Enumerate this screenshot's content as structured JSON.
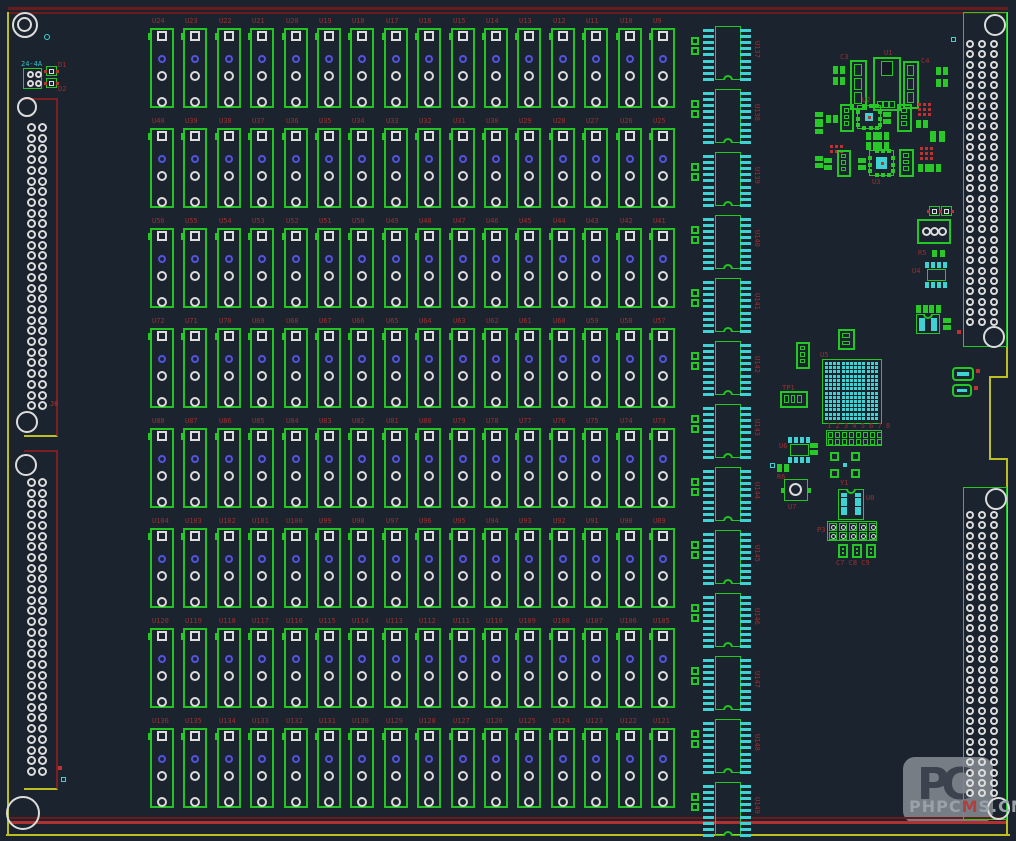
{
  "watermark": {
    "logo": "PC",
    "text_left": "PHPC",
    "text_accent": "M",
    "text_right": "S.CN"
  },
  "colors": {
    "background": "#1b232e",
    "green": "#21c421",
    "bright_green": "#2ad82a",
    "cyan_pad": "#3ed2d2",
    "cyan_text": "#2fc2c2",
    "white_pad": "#dcdcdc",
    "blue_pad": "#5253de",
    "ref_red": "#9c2f2f",
    "via_red": "#c03030",
    "edge_dark_red": "#6a1b1b",
    "edge_red": "#b23030",
    "edge_yellow": "#bdbd24"
  },
  "outline": [
    {
      "x": 8,
      "y": 7,
      "w": 1000,
      "h": 3,
      "c": "#6a1b1b"
    },
    {
      "x": 8,
      "y": 12,
      "w": 1000,
      "h": 2,
      "c": "#6a1b1b"
    },
    {
      "x": 8,
      "y": 817,
      "w": 1000,
      "h": 2,
      "c": "#6a1b1b"
    },
    {
      "x": 8,
      "y": 821,
      "w": 1000,
      "h": 3,
      "c": "#b23030"
    },
    {
      "x": 6,
      "y": 834,
      "w": 1004,
      "h": 2,
      "c": "#bdbd24"
    },
    {
      "x": 7,
      "y": 12,
      "w": 2,
      "h": 824,
      "c": "#bdbd24"
    },
    {
      "x": 1006,
      "y": 12,
      "w": 2,
      "h": 366,
      "c": "#bdbd24"
    },
    {
      "x": 990,
      "y": 376,
      "w": 18,
      "h": 2,
      "c": "#bdbd24"
    },
    {
      "x": 989,
      "y": 376,
      "w": 2,
      "h": 84,
      "c": "#bdbd24"
    },
    {
      "x": 990,
      "y": 458,
      "w": 18,
      "h": 2,
      "c": "#bdbd24"
    },
    {
      "x": 1006,
      "y": 458,
      "w": 2,
      "h": 378,
      "c": "#bdbd24"
    }
  ],
  "grid": {
    "origin_x": 150,
    "origin_y": 28,
    "pitch_x": 33.4,
    "pitch_y": 100,
    "fp_w": 24,
    "fp_h": 80,
    "rows": 8,
    "cols": 16,
    "refs": [
      "U24",
      "U23",
      "U22",
      "U21",
      "U20",
      "U19",
      "U18",
      "U17",
      "U16",
      "U15",
      "U14",
      "U13",
      "U12",
      "U11",
      "U10",
      "U9",
      "U40",
      "U39",
      "U38",
      "U37",
      "U36",
      "U35",
      "U34",
      "U33",
      "U32",
      "U31",
      "U30",
      "U29",
      "U28",
      "U27",
      "U26",
      "U25",
      "U56",
      "U55",
      "U54",
      "U53",
      "U52",
      "U51",
      "U50",
      "U49",
      "U48",
      "U47",
      "U46",
      "U45",
      "U44",
      "U43",
      "U42",
      "U41",
      "U72",
      "U71",
      "U70",
      "U69",
      "U68",
      "U67",
      "U66",
      "U65",
      "U64",
      "U63",
      "U62",
      "U61",
      "U60",
      "U59",
      "U58",
      "U57",
      "U88",
      "U87",
      "U86",
      "U85",
      "U84",
      "U83",
      "U82",
      "U81",
      "U80",
      "U79",
      "U78",
      "U77",
      "U76",
      "U75",
      "U74",
      "U73",
      "U104",
      "U103",
      "U102",
      "U101",
      "U100",
      "U99",
      "U98",
      "U97",
      "U96",
      "U95",
      "U94",
      "U93",
      "U92",
      "U91",
      "U90",
      "U89",
      "U120",
      "U119",
      "U118",
      "U117",
      "U116",
      "U115",
      "U114",
      "U113",
      "U112",
      "U111",
      "U110",
      "U109",
      "U108",
      "U107",
      "U106",
      "U105",
      "U136",
      "U135",
      "U134",
      "U133",
      "U132",
      "U131",
      "U130",
      "U129",
      "U128",
      "U127",
      "U126",
      "U125",
      "U124",
      "U123",
      "U122",
      "U121"
    ]
  },
  "dips": {
    "x": 703,
    "y0": 25,
    "pitch": 63,
    "h": 56,
    "count": 13,
    "refs": [
      "U137",
      "U138",
      "U139",
      "U140",
      "U141",
      "U142",
      "U143",
      "U144",
      "U145",
      "U146",
      "U147",
      "U148",
      "U149"
    ]
  },
  "left_connectors": [
    {
      "x": 24,
      "y": 98,
      "w": 34,
      "h": 339,
      "pad_y0": 123,
      "rows": 27,
      "label": "J6",
      "label_x": 50,
      "label_y": 401
    },
    {
      "x": 24,
      "y": 450,
      "w": 34,
      "h": 340,
      "pad_y0": 478,
      "rows": 28,
      "label": "",
      "label_x": 0,
      "label_y": 0
    }
  ],
  "right_connectors": [
    {
      "x": 963,
      "y": 12,
      "w": 44,
      "h": 335,
      "pad_y0": 40,
      "rows": 28
    },
    {
      "x": 963,
      "y": 487,
      "w": 44,
      "h": 333,
      "pad_y0": 511,
      "rows": 28
    }
  ],
  "holes": [
    {
      "x": 12,
      "y": 12,
      "d": 26
    },
    {
      "x": 17,
      "y": 17,
      "d": 15
    },
    {
      "x": 6,
      "y": 796,
      "d": 34
    },
    {
      "x": 987,
      "y": 797,
      "d": 23
    },
    {
      "x": 17,
      "y": 97,
      "d": 20
    },
    {
      "x": 16,
      "y": 411,
      "d": 22
    },
    {
      "x": 15,
      "y": 454,
      "d": 22
    },
    {
      "x": 984,
      "y": 14,
      "d": 22
    },
    {
      "x": 983,
      "y": 326,
      "d": 22
    },
    {
      "x": 985,
      "y": 488,
      "d": 22
    }
  ],
  "components": [
    {
      "t": "r2h",
      "x": 833,
      "y": 66
    },
    {
      "t": "r2h",
      "x": 833,
      "y": 77
    },
    {
      "t": "cap3v",
      "x": 850,
      "y": 60,
      "w": 17,
      "h": 50,
      "lbl": "C3",
      "lx": 840,
      "ly": 54
    },
    {
      "t": "reg",
      "x": 873,
      "y": 57,
      "w": 28,
      "h": 54,
      "lbl": "U1",
      "lx": 884,
      "ly": 50
    },
    {
      "t": "cap3v",
      "x": 903,
      "y": 61,
      "w": 16,
      "h": 48,
      "lbl": "C4",
      "lx": 921,
      "ly": 58
    },
    {
      "t": "r2h",
      "x": 936,
      "y": 67
    },
    {
      "t": "r2h",
      "x": 936,
      "y": 79
    },
    {
      "t": "r2v",
      "x": 815,
      "y": 112
    },
    {
      "t": "r2v",
      "x": 815,
      "y": 122
    },
    {
      "t": "r2h",
      "x": 826,
      "y": 115
    },
    {
      "t": "cap3v",
      "x": 840,
      "y": 104,
      "w": 14,
      "h": 28
    },
    {
      "t": "qfn",
      "x": 857,
      "y": 105,
      "w": 24,
      "h": 24,
      "lbl": "U2",
      "lx": 862,
      "ly": 97
    },
    {
      "t": "r2v",
      "x": 883,
      "y": 112
    },
    {
      "t": "cap3v",
      "x": 897,
      "y": 104,
      "w": 15,
      "h": 28
    },
    {
      "t": "via",
      "x": 918,
      "y": 103,
      "r": 3,
      "c": 3
    },
    {
      "t": "r2h",
      "x": 916,
      "y": 120
    },
    {
      "t": "r2h",
      "x": 866,
      "y": 132
    },
    {
      "t": "r2h",
      "x": 877,
      "y": 132
    },
    {
      "t": "r2h",
      "x": 930,
      "y": 131,
      "w": 15,
      "h": 11
    },
    {
      "t": "via",
      "x": 830,
      "y": 145,
      "r": 2,
      "c": 3
    },
    {
      "t": "cap3v",
      "x": 837,
      "y": 150,
      "w": 14,
      "h": 27
    },
    {
      "t": "r2v",
      "x": 815,
      "y": 156
    },
    {
      "t": "r2v",
      "x": 824,
      "y": 158
    },
    {
      "t": "r2h",
      "x": 866,
      "y": 142
    },
    {
      "t": "r2h",
      "x": 877,
      "y": 142
    },
    {
      "t": "qfn",
      "x": 869,
      "y": 150,
      "w": 25,
      "h": 26,
      "big": 1,
      "lbl": "U3",
      "lx": 872,
      "ly": 179
    },
    {
      "t": "r2v",
      "x": 858,
      "y": 158
    },
    {
      "t": "cap3v",
      "x": 899,
      "y": 149,
      "w": 15,
      "h": 28
    },
    {
      "t": "via",
      "x": 920,
      "y": 147,
      "r": 3,
      "c": 3
    },
    {
      "t": "r2h",
      "x": 918,
      "y": 164
    },
    {
      "t": "r2h",
      "x": 929,
      "y": 164
    },
    {
      "t": "tealsq",
      "x": 951,
      "y": 37
    },
    {
      "t": "sq2red",
      "x": 929,
      "y": 206
    },
    {
      "t": "sq2red",
      "x": 941,
      "y": 206
    },
    {
      "t": "circle3",
      "x": 917,
      "y": 219,
      "w": 34,
      "h": 25
    },
    {
      "t": "r2h",
      "x": 932,
      "y": 250,
      "w": 13,
      "h": 7,
      "lbl": "R5",
      "lx": 918,
      "ly": 250
    },
    {
      "t": "soic8h",
      "x": 924,
      "y": 262,
      "lbl": "U4",
      "lx": 912,
      "ly": 268
    },
    {
      "t": "r2h",
      "x": 916,
      "y": 305
    },
    {
      "t": "r2h",
      "x": 929,
      "y": 305
    },
    {
      "t": "soicw",
      "x": 916,
      "y": 314,
      "w": 24,
      "h": 20,
      "segs": 4
    },
    {
      "t": "r2v",
      "x": 943,
      "y": 318
    },
    {
      "t": "cap3v",
      "x": 796,
      "y": 342,
      "w": 14,
      "h": 27
    },
    {
      "t": "cap2v",
      "x": 838,
      "y": 329,
      "w": 17,
      "h": 21
    },
    {
      "t": "bga",
      "x": 822,
      "y": 359,
      "w": 60,
      "h": 65,
      "lbl": "U5",
      "lx": 820,
      "ly": 352
    },
    {
      "t": "cap3h",
      "x": 780,
      "y": 391,
      "w": 28,
      "h": 17,
      "lbl": "TP1",
      "lx": 782,
      "ly": 385
    },
    {
      "t": "hdr",
      "x": 826,
      "y": 430,
      "cols": 8,
      "lbl": "1 2 3 4 5 6 7 8",
      "lx": 827,
      "ly": 423
    },
    {
      "t": "soic8h",
      "x": 787,
      "y": 437,
      "lbl": "U6",
      "lx": 779,
      "ly": 443
    },
    {
      "t": "r2v",
      "x": 810,
      "y": 443
    },
    {
      "t": "qfp4",
      "x": 830,
      "y": 452,
      "w": 30,
      "h": 26,
      "lbl": "Y1",
      "lx": 840,
      "ly": 480
    },
    {
      "t": "tealsq",
      "x": 770,
      "y": 463
    },
    {
      "t": "r2h",
      "x": 777,
      "y": 464,
      "lbl": "R6",
      "lx": 777,
      "ly": 474
    },
    {
      "t": "circle1",
      "x": 784,
      "y": 479,
      "w": 24,
      "h": 22,
      "lbl": "U7",
      "lx": 788,
      "ly": 504
    },
    {
      "t": "soicw",
      "x": 838,
      "y": 489,
      "w": 26,
      "h": 31,
      "segs": 5,
      "lbl": "U8",
      "lx": 866,
      "ly": 495
    },
    {
      "t": "hdr2x5",
      "x": 827,
      "y": 521,
      "lbl": "P3",
      "lx": 817,
      "ly": 527
    },
    {
      "t": "cap2v",
      "x": 838,
      "y": 544,
      "w": 10,
      "h": 14
    },
    {
      "t": "cap2v",
      "x": 852,
      "y": 544,
      "w": 10,
      "h": 14
    },
    {
      "t": "cap2v",
      "x": 866,
      "y": 544,
      "w": 10,
      "h": 14
    },
    {
      "t": "part2cyan",
      "x": 952,
      "y": 367,
      "w": 22,
      "h": 14
    },
    {
      "t": "part2cyan",
      "x": 952,
      "y": 384,
      "w": 20,
      "h": 13
    },
    {
      "t": "reddot",
      "x": 976,
      "y": 369
    },
    {
      "t": "reddot",
      "x": 974,
      "y": 386
    },
    {
      "t": "reddot",
      "x": 957,
      "y": 330
    },
    {
      "t": "conn2x2",
      "x": 23,
      "y": 68,
      "w": 19,
      "h": 21,
      "lbl": "24-4A",
      "lcyan": 1,
      "lx": 21,
      "ly": 61
    },
    {
      "t": "sq2red",
      "x": 46,
      "y": 66,
      "lbl": "D1",
      "lx": 58,
      "ly": 62
    },
    {
      "t": "sq2red",
      "x": 46,
      "y": 78,
      "lbl": "D2",
      "lx": 58,
      "ly": 86
    },
    {
      "t": "tealring",
      "x": 44,
      "y": 34
    },
    {
      "t": "reddot",
      "x": 58,
      "y": 766
    },
    {
      "t": "tealsq",
      "x": 61,
      "y": 777
    }
  ],
  "labels": [
    {
      "t": "C7 C8 C9",
      "x": 836,
      "y": 560
    },
    {
      "t": "J6",
      "x": 50,
      "y": 401
    }
  ]
}
